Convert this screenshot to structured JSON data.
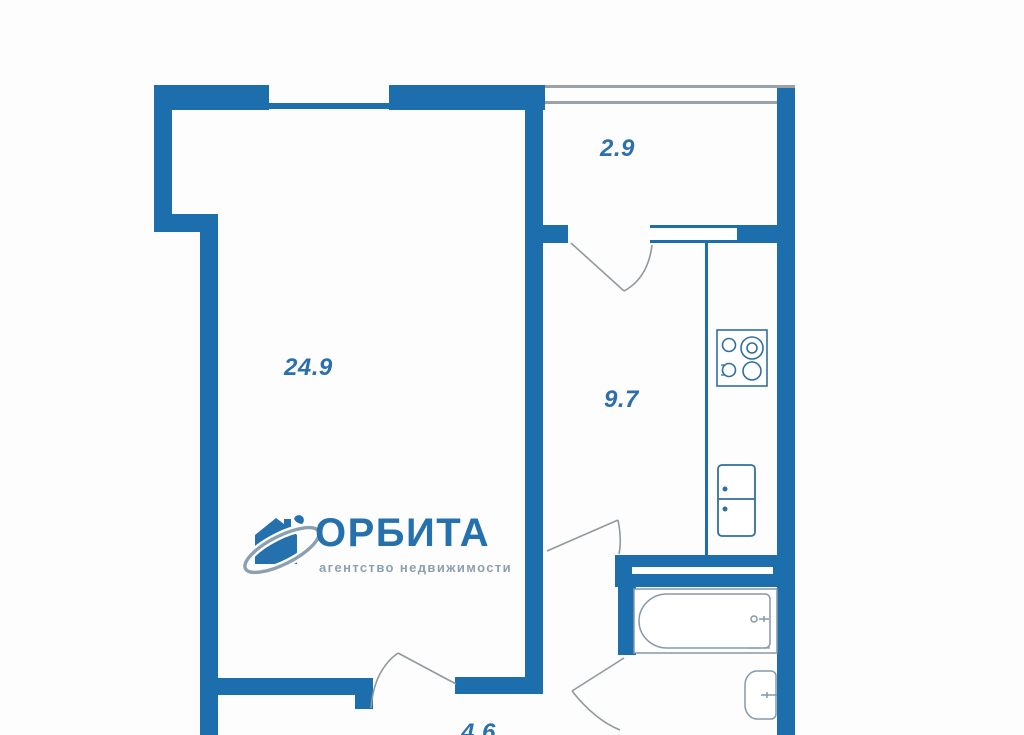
{
  "rooms": {
    "living": {
      "label": "24.9"
    },
    "balcony": {
      "label": "2.9"
    },
    "kitchen": {
      "label": "9.7"
    },
    "hallway": {
      "label": "4.6"
    }
  },
  "logo": {
    "title": "ОРБИТА",
    "subtitle": "агентство недвижимости",
    "icon": "house-orbit-icon"
  },
  "icons": {
    "stove": "stove-icon",
    "fridge": "fridge-icon",
    "bathtub": "bathtub-icon",
    "toilet": "toilet-icon"
  },
  "colors": {
    "wall": "#1c6ead",
    "label": "#2b6fad",
    "logoBlue": "#2471ae",
    "logoGray": "#8da0b0",
    "doorLine": "#909a9e",
    "fixture": "#8699a8",
    "fixtureDark": "#2f6f9f",
    "glazing": "#9aa2a6",
    "background": "#fdfdfd"
  }
}
